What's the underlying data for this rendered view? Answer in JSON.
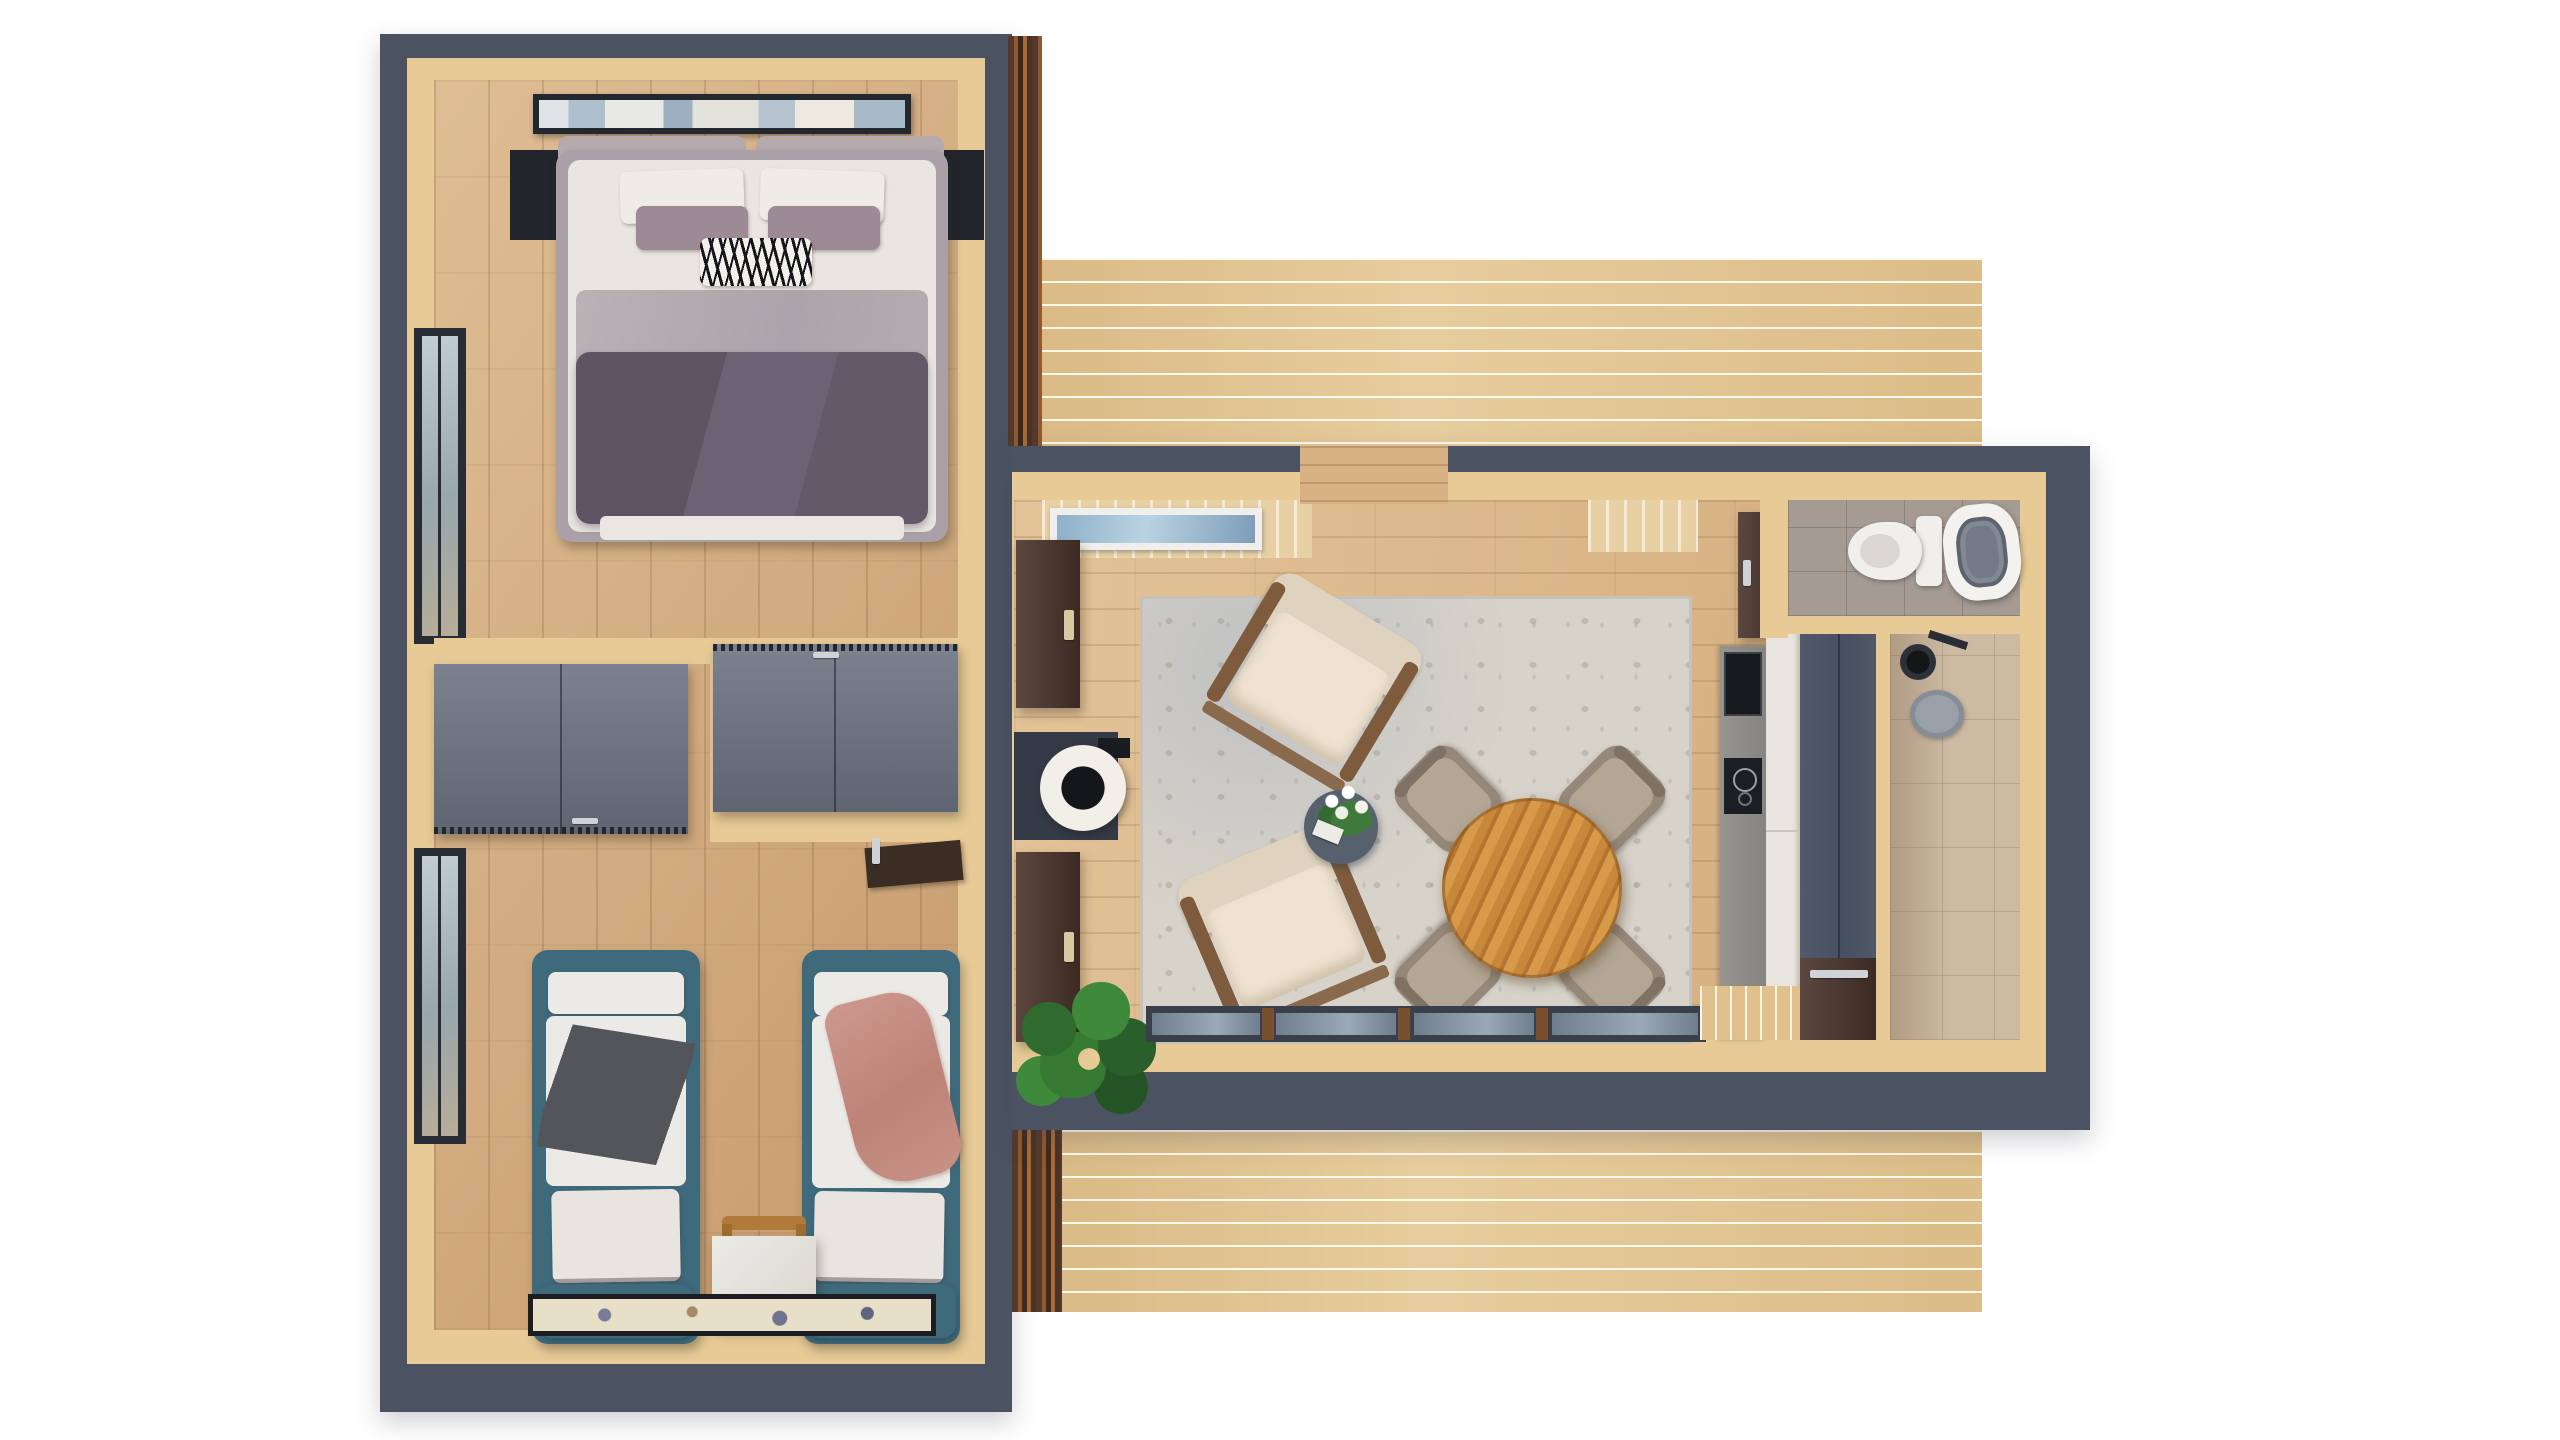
{
  "scene": {
    "title": "Top-down 3D floor plan render of a tiny house with two bedrooms, living-dining room, kitchen, bathroom and two terraces",
    "background": "#ffffff",
    "palette": {
      "wall": "#4b5363",
      "trim": "#e7ca96",
      "bedroom_floor": "#d2a97b",
      "living_floor": "#dab485",
      "deck": "#e4c795",
      "siding": "#5a3a28",
      "wardrobe_gray": "#69707e",
      "bed_teal": "#3e6a7c",
      "duvet_purple": "#665d6d",
      "kitchen_unit": "#4d5565",
      "door_brown": "#48332a",
      "wc_tile": "#a59b92",
      "shower_tile": "#cdbaa3",
      "dining_wood": "#c8883b",
      "accent_green": "#2f6b2f"
    },
    "left_wing": {
      "name": "bedroom wing",
      "rooms": [
        {
          "name": "master bedroom",
          "furniture": [
            "wall art",
            "double bed with purple duvet",
            "left nightstand",
            "right nightstand",
            "tall window"
          ]
        },
        {
          "name": "wardrobe hallway",
          "furniture": [
            "gray wardrobe cabinet left",
            "gray wardrobe cabinet right",
            "wall-mounted desk shelf"
          ]
        },
        {
          "name": "twin bedroom",
          "furniture": [
            "single bed with gray throw",
            "single bed with pink throw",
            "white nightstand",
            "wooden chair",
            "runner rug",
            "tall window"
          ]
        }
      ]
    },
    "right_wing": {
      "name": "living wing",
      "rooms": [
        {
          "name": "living-dining room",
          "furniture": [
            "area rug",
            "armchair upper",
            "armchair lower",
            "round side table with flowers",
            "round dining table",
            "four dining chairs",
            "wood stove",
            "tall brown cabinet upper",
            "tall brown cabinet lower",
            "potted plant",
            "clerestory window",
            "sliding glass doors"
          ]
        },
        {
          "name": "kitchen",
          "furniture": [
            "stone counter",
            "built-in oven",
            "induction hob",
            "white cabinet fronts",
            "tall blue-gray unit",
            "brown lower door"
          ]
        },
        {
          "name": "wc",
          "furniture": [
            "toilet",
            "round basin tub",
            "brown door"
          ]
        },
        {
          "name": "shower room",
          "furniture": [
            "shower head",
            "round shower stool"
          ]
        },
        {
          "name": "north terrace",
          "furniture": [
            "wood decking"
          ]
        },
        {
          "name": "south terrace",
          "furniture": [
            "wood decking",
            "entry porch"
          ]
        }
      ]
    }
  }
}
